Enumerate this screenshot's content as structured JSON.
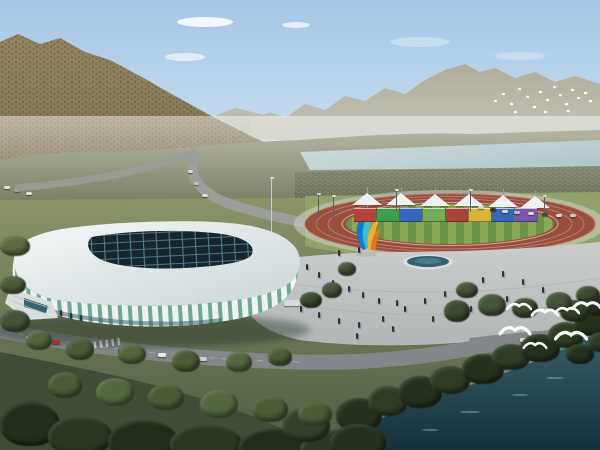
{
  "scene": {
    "description": "Aerial architectural rendering of a riverside sports complex: white lattice indoor stadium, athletics track with rainbow wall and white canopy tents, colorful flame sculpture, plaza with fountain, roads, forested mountains, river and flying white birds",
    "counts": {
      "tents": 6,
      "banner_segments": 8,
      "large_gulls": 7,
      "distant_birds": 18
    },
    "trees": [
      {
        "x": 336,
        "y": 398,
        "w": 46,
        "h": 34,
        "c": "#26321f"
      },
      {
        "x": 368,
        "y": 386,
        "w": 40,
        "h": 30,
        "c": "#2f3d27"
      },
      {
        "x": 398,
        "y": 376,
        "w": 44,
        "h": 32,
        "c": "#26321f"
      },
      {
        "x": 430,
        "y": 366,
        "w": 40,
        "h": 28,
        "c": "#2f3d27"
      },
      {
        "x": 462,
        "y": 354,
        "w": 42,
        "h": 30,
        "c": "#26321f"
      },
      {
        "x": 492,
        "y": 344,
        "w": 38,
        "h": 26,
        "c": "#2f3d27"
      },
      {
        "x": 520,
        "y": 334,
        "w": 40,
        "h": 28,
        "c": "#26321f"
      },
      {
        "x": 548,
        "y": 322,
        "w": 36,
        "h": 26,
        "c": "#2f3d27"
      },
      {
        "x": 574,
        "y": 312,
        "w": 34,
        "h": 24,
        "c": "#26321f"
      },
      {
        "x": 560,
        "y": 300,
        "w": 30,
        "h": 22,
        "c": "#33402a"
      },
      {
        "x": 585,
        "y": 296,
        "w": 26,
        "h": 20,
        "c": "#26321f"
      },
      {
        "x": 0,
        "y": 402,
        "w": 60,
        "h": 44,
        "c": "#222e1c"
      },
      {
        "x": 48,
        "y": 416,
        "w": 64,
        "h": 40,
        "c": "#2b3823"
      },
      {
        "x": 108,
        "y": 420,
        "w": 70,
        "h": 42,
        "c": "#222e1c"
      },
      {
        "x": 170,
        "y": 424,
        "w": 72,
        "h": 40,
        "c": "#2b3823"
      },
      {
        "x": 238,
        "y": 428,
        "w": 76,
        "h": 40,
        "c": "#222e1c"
      },
      {
        "x": 300,
        "y": 430,
        "w": 70,
        "h": 40,
        "c": "#2b3823"
      },
      {
        "x": 282,
        "y": 408,
        "w": 48,
        "h": 34,
        "c": "#33402a"
      },
      {
        "x": 330,
        "y": 424,
        "w": 56,
        "h": 36,
        "c": "#26321f"
      },
      {
        "x": 48,
        "y": 372,
        "w": 34,
        "h": 26,
        "c": "#4c5c38"
      },
      {
        "x": 96,
        "y": 378,
        "w": 38,
        "h": 28,
        "c": "#556740"
      },
      {
        "x": 148,
        "y": 384,
        "w": 36,
        "h": 26,
        "c": "#4c5c38"
      },
      {
        "x": 200,
        "y": 390,
        "w": 38,
        "h": 28,
        "c": "#556740"
      },
      {
        "x": 252,
        "y": 396,
        "w": 36,
        "h": 26,
        "c": "#4c5c38"
      },
      {
        "x": 298,
        "y": 402,
        "w": 34,
        "h": 24,
        "c": "#4c5c38"
      },
      {
        "x": 26,
        "y": 330,
        "w": 26,
        "h": 20,
        "c": "#54663e"
      },
      {
        "x": 66,
        "y": 338,
        "w": 28,
        "h": 22,
        "c": "#4c5c38"
      },
      {
        "x": 118,
        "y": 344,
        "w": 28,
        "h": 20,
        "c": "#54663e"
      },
      {
        "x": 172,
        "y": 350,
        "w": 28,
        "h": 22,
        "c": "#4c5c38"
      },
      {
        "x": 226,
        "y": 352,
        "w": 26,
        "h": 20,
        "c": "#54663e"
      },
      {
        "x": 268,
        "y": 348,
        "w": 24,
        "h": 18,
        "c": "#4c5c38"
      },
      {
        "x": 444,
        "y": 300,
        "w": 26,
        "h": 22,
        "c": "#3c4a2e"
      },
      {
        "x": 478,
        "y": 294,
        "w": 28,
        "h": 22,
        "c": "#46543a"
      },
      {
        "x": 512,
        "y": 298,
        "w": 26,
        "h": 20,
        "c": "#3c4a2e"
      },
      {
        "x": 546,
        "y": 292,
        "w": 26,
        "h": 20,
        "c": "#46543a"
      },
      {
        "x": 576,
        "y": 286,
        "w": 24,
        "h": 18,
        "c": "#3c4a2e"
      },
      {
        "x": 456,
        "y": 282,
        "w": 22,
        "h": 16,
        "c": "#46543a"
      },
      {
        "x": 322,
        "y": 282,
        "w": 20,
        "h": 16,
        "c": "#46543a"
      },
      {
        "x": 300,
        "y": 292,
        "w": 22,
        "h": 16,
        "c": "#3c4a2e"
      },
      {
        "x": 338,
        "y": 262,
        "w": 18,
        "h": 14,
        "c": "#46543a"
      },
      {
        "x": 0,
        "y": 236,
        "w": 30,
        "h": 20,
        "c": "#5d6b42"
      },
      {
        "x": 0,
        "y": 276,
        "w": 26,
        "h": 18,
        "c": "#4c5c38"
      },
      {
        "x": 0,
        "y": 310,
        "w": 30,
        "h": 22,
        "c": "#44523a"
      },
      {
        "x": 588,
        "y": 332,
        "w": 26,
        "h": 20,
        "c": "#2f3d27"
      },
      {
        "x": 566,
        "y": 344,
        "w": 28,
        "h": 20,
        "c": "#26321f"
      }
    ],
    "cars": [
      {
        "x": 26,
        "y": 336,
        "w": 9,
        "h": 4,
        "c": "#e9eaea"
      },
      {
        "x": 52,
        "y": 340,
        "w": 8,
        "h": 4,
        "c": "#b03026"
      },
      {
        "x": 82,
        "y": 344,
        "w": 9,
        "h": 4,
        "c": "#dadcdc"
      },
      {
        "x": 118,
        "y": 349,
        "w": 9,
        "h": 4,
        "c": "#35393d"
      },
      {
        "x": 158,
        "y": 353,
        "w": 8,
        "h": 4,
        "c": "#e9eaea"
      },
      {
        "x": 198,
        "y": 357,
        "w": 9,
        "h": 4,
        "c": "#c9cccc"
      },
      {
        "x": 238,
        "y": 359,
        "w": 8,
        "h": 4,
        "c": "#7e2a22"
      },
      {
        "x": 268,
        "y": 357,
        "w": 9,
        "h": 4,
        "c": "#e3e4e4"
      },
      {
        "x": 284,
        "y": 300,
        "w": 16,
        "h": 6,
        "c": "#d6dad9"
      },
      {
        "x": 4,
        "y": 186,
        "w": 6,
        "h": 3,
        "c": "#dcdddd"
      },
      {
        "x": 14,
        "y": 189,
        "w": 6,
        "h": 3,
        "c": "#9aa0a2"
      },
      {
        "x": 26,
        "y": 192,
        "w": 6,
        "h": 3,
        "c": "#e2e3e3"
      },
      {
        "x": 188,
        "y": 170,
        "w": 5,
        "h": 3,
        "c": "#d5d6d6"
      },
      {
        "x": 194,
        "y": 182,
        "w": 5,
        "h": 3,
        "c": "#c2c4c4"
      },
      {
        "x": 202,
        "y": 194,
        "w": 6,
        "h": 3,
        "c": "#dddede"
      },
      {
        "x": 478,
        "y": 206,
        "w": 6,
        "h": 3,
        "c": "#d8dada"
      },
      {
        "x": 490,
        "y": 208,
        "w": 6,
        "h": 3,
        "c": "#32373b"
      },
      {
        "x": 502,
        "y": 210,
        "w": 6,
        "h": 3,
        "c": "#d8dada"
      },
      {
        "x": 514,
        "y": 211,
        "w": 6,
        "h": 3,
        "c": "#b8babb"
      },
      {
        "x": 528,
        "y": 212,
        "w": 6,
        "h": 3,
        "c": "#d8dada"
      },
      {
        "x": 542,
        "y": 213,
        "w": 6,
        "h": 3,
        "c": "#43484c"
      },
      {
        "x": 556,
        "y": 214,
        "w": 6,
        "h": 3,
        "c": "#d8dada"
      },
      {
        "x": 570,
        "y": 214,
        "w": 6,
        "h": 3,
        "c": "#c8caca"
      },
      {
        "x": 520,
        "y": 338,
        "w": 8,
        "h": 4,
        "c": "#d8dada"
      },
      {
        "x": 556,
        "y": 334,
        "w": 8,
        "h": 4,
        "c": "#3a3f43"
      }
    ],
    "people": [
      {
        "x": 306,
        "y": 264
      },
      {
        "x": 318,
        "y": 272
      },
      {
        "x": 332,
        "y": 280
      },
      {
        "x": 348,
        "y": 286
      },
      {
        "x": 362,
        "y": 292
      },
      {
        "x": 378,
        "y": 298
      },
      {
        "x": 396,
        "y": 300
      },
      {
        "x": 300,
        "y": 306
      },
      {
        "x": 318,
        "y": 312
      },
      {
        "x": 338,
        "y": 318
      },
      {
        "x": 358,
        "y": 322
      },
      {
        "x": 382,
        "y": 316
      },
      {
        "x": 404,
        "y": 306
      },
      {
        "x": 424,
        "y": 298
      },
      {
        "x": 444,
        "y": 291
      },
      {
        "x": 462,
        "y": 284
      },
      {
        "x": 482,
        "y": 277
      },
      {
        "x": 502,
        "y": 271
      },
      {
        "x": 522,
        "y": 279
      },
      {
        "x": 542,
        "y": 287
      },
      {
        "x": 506,
        "y": 296
      },
      {
        "x": 470,
        "y": 306
      },
      {
        "x": 432,
        "y": 316
      },
      {
        "x": 392,
        "y": 326
      },
      {
        "x": 356,
        "y": 333
      },
      {
        "x": 60,
        "y": 310
      },
      {
        "x": 70,
        "y": 313
      },
      {
        "x": 80,
        "y": 315
      },
      {
        "x": 338,
        "y": 250
      },
      {
        "x": 358,
        "y": 247
      }
    ],
    "gulls": [
      {
        "x": 506,
        "y": 300,
        "s": 1
      },
      {
        "x": 532,
        "y": 306,
        "s": 1.1
      },
      {
        "x": 554,
        "y": 304,
        "s": 1
      },
      {
        "x": 574,
        "y": 299,
        "s": 1.2
      },
      {
        "x": 502,
        "y": 324,
        "s": 1.25
      },
      {
        "x": 558,
        "y": 329,
        "s": 1.3
      },
      {
        "x": 522,
        "y": 339,
        "s": 0.95
      }
    ],
    "distant_birds": [
      {
        "x": 494,
        "y": 100
      },
      {
        "x": 502,
        "y": 93
      },
      {
        "x": 510,
        "y": 103
      },
      {
        "x": 518,
        "y": 88
      },
      {
        "x": 526,
        "y": 96
      },
      {
        "x": 533,
        "y": 106
      },
      {
        "x": 539,
        "y": 91
      },
      {
        "x": 546,
        "y": 99
      },
      {
        "x": 553,
        "y": 86
      },
      {
        "x": 559,
        "y": 94
      },
      {
        "x": 565,
        "y": 103
      },
      {
        "x": 571,
        "y": 89
      },
      {
        "x": 577,
        "y": 97
      },
      {
        "x": 584,
        "y": 92
      },
      {
        "x": 589,
        "y": 100
      },
      {
        "x": 514,
        "y": 111
      },
      {
        "x": 544,
        "y": 111
      },
      {
        "x": 567,
        "y": 110
      }
    ],
    "tents": [
      {
        "x": 352,
        "y": 190
      },
      {
        "x": 386,
        "y": 190
      },
      {
        "x": 420,
        "y": 191
      },
      {
        "x": 454,
        "y": 191
      },
      {
        "x": 488,
        "y": 192
      },
      {
        "x": 520,
        "y": 193
      }
    ],
    "banners": [
      {
        "x": 354,
        "y": 208,
        "c": "#b5453a"
      },
      {
        "x": 377,
        "y": 208,
        "c": "#3f9e4d"
      },
      {
        "x": 400,
        "y": 208,
        "c": "#3566b8"
      },
      {
        "x": 423,
        "y": 208,
        "c": "#6fae57"
      },
      {
        "x": 446,
        "y": 208,
        "c": "#a8433a"
      },
      {
        "x": 469,
        "y": 208,
        "c": "#d8b53a"
      },
      {
        "x": 492,
        "y": 208,
        "c": "#3566b8"
      },
      {
        "x": 515,
        "y": 208,
        "c": "#7a57ad"
      }
    ],
    "poles": [
      {
        "x": 271,
        "y": 178,
        "h": 54,
        "c": "#c8cdcf"
      },
      {
        "x": 318,
        "y": 194,
        "h": 24,
        "c": "#5a6065"
      },
      {
        "x": 396,
        "y": 190,
        "h": 22,
        "c": "#5a6065"
      },
      {
        "x": 470,
        "y": 190,
        "h": 22,
        "c": "#5a6065"
      },
      {
        "x": 544,
        "y": 196,
        "h": 20,
        "c": "#5a6065"
      },
      {
        "x": 333,
        "y": 196,
        "h": 22,
        "c": "#5a6065"
      }
    ]
  },
  "colors": {
    "sky_top": "#a5c6e6",
    "sky_mid": "#c9ddee",
    "sky_bottom": "#edf2f4",
    "cloud": "#ffffff",
    "far_top": "#b0ac99",
    "far_bottom": "#c4c7bc",
    "ridge_mid": "#b9b6a6",
    "mtn_top": "#94845f",
    "mtn_bottom": "#7a7356",
    "mtn_speckle": "#4f4a36",
    "valley_top": "#85876c",
    "valley_bottom": "#767a5e",
    "river_left": "#b8c9ca",
    "river_right": "#9fb6bb",
    "shore_veg": "#6e7358",
    "veg_speckle": "#39402e",
    "ground_top": "#8c9468",
    "ground_bottom": "#4e5b44",
    "lawn": "#93a26b",
    "apron": "#c8cdbf",
    "track": "#9a4e3c",
    "track_rim": "#b86a55",
    "lane_line": "#ffffff",
    "field_light": "#8aa957",
    "field_dark": "#6e9247",
    "road": "#9b9e99",
    "boulevard": "#83878a",
    "parking": "#9a9e9c",
    "plaza_top": "#cbcecd",
    "plaza_bottom": "#b2b6b6",
    "fountain_rim": "#d9dddd",
    "fountain_dark": "#36616d",
    "fountain_water": "#4b8292",
    "stadium_white_hi": "#f4f7f7",
    "stadium_white_lo": "#ccd6d7",
    "glass": "#6fa893",
    "fin": "#eef2f2",
    "roof_dark": "#18262e",
    "roof_grid": "#5d96a0",
    "entrance": "#d9dedf",
    "entrance_glass": "#39626f",
    "shadow": "#1c2a24",
    "sculpt_blue": "#1976c8",
    "sculpt_cyan": "#35c3e8",
    "sculpt_yellow": "#f2b02c",
    "sculpt_orange": "#e07820",
    "sculpt_base": "#b9bdbd",
    "water_top": "#3a5f68",
    "water_bottom": "#16303a",
    "water_edge": "#9fb9b6",
    "fg_grass": "#3f4d37",
    "rock_band": "#5f5844"
  }
}
